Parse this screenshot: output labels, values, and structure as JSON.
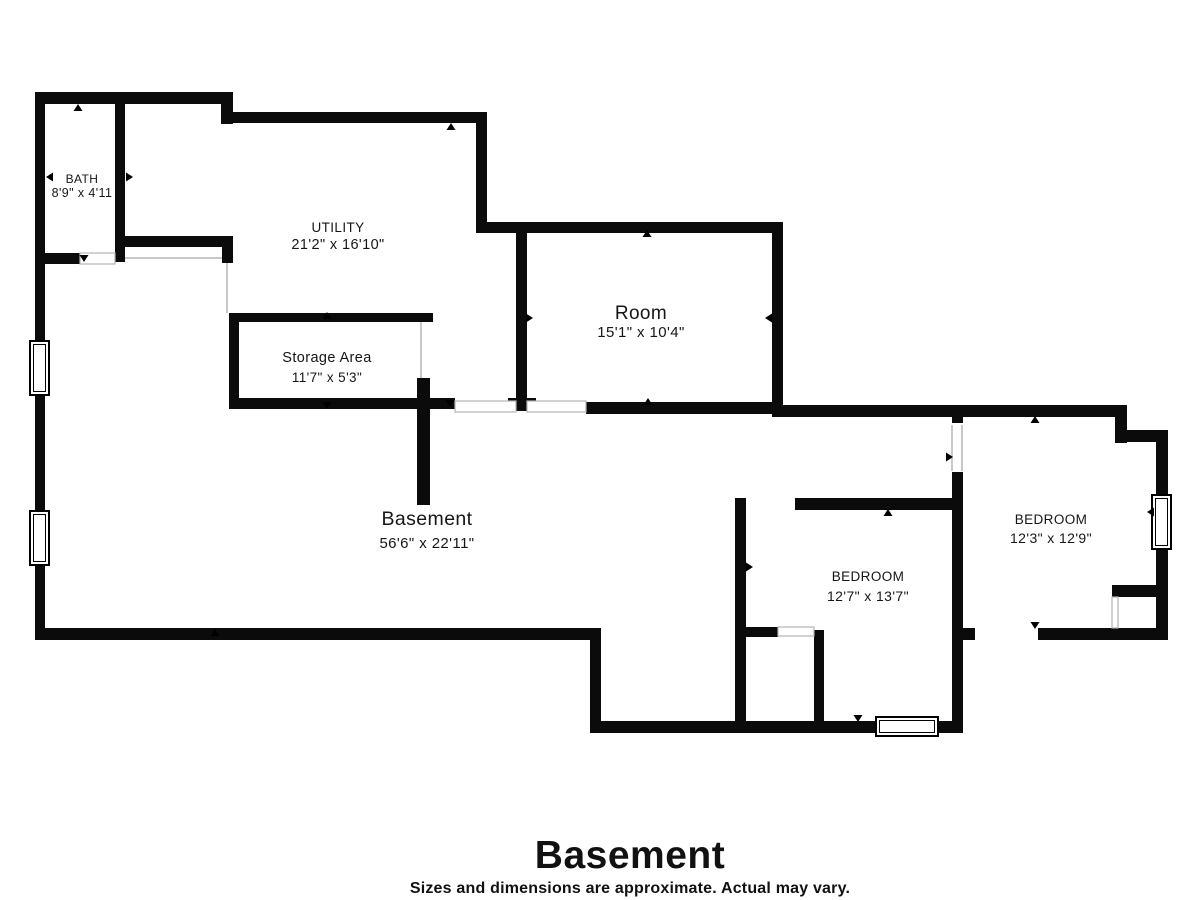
{
  "plan": {
    "wall_color": "#0b0b0b",
    "thin_color": "#b5b5b5",
    "text_color": "#161616",
    "walls": [
      [
        35,
        92,
        197,
        12
      ],
      [
        221,
        92,
        12,
        32
      ],
      [
        221,
        112,
        266,
        11
      ],
      [
        476,
        112,
        11,
        121
      ],
      [
        476,
        222,
        307,
        11
      ],
      [
        772,
        222,
        11,
        195
      ],
      [
        772,
        405,
        355,
        12
      ],
      [
        1115,
        405,
        12,
        38
      ],
      [
        1115,
        430,
        53,
        12
      ],
      [
        1156,
        430,
        12,
        210
      ],
      [
        1038,
        628,
        130,
        12
      ],
      [
        952,
        628,
        23,
        12
      ],
      [
        952,
        405,
        11,
        18
      ],
      [
        952,
        472,
        11,
        261
      ],
      [
        590,
        721,
        373,
        12
      ],
      [
        590,
        628,
        11,
        105
      ],
      [
        35,
        628,
        566,
        12
      ],
      [
        35,
        92,
        10,
        548
      ],
      [
        115,
        98,
        10,
        164
      ],
      [
        40,
        253,
        40,
        11
      ],
      [
        125,
        236,
        108,
        11
      ],
      [
        222,
        236,
        11,
        27
      ],
      [
        229,
        313,
        204,
        9
      ],
      [
        229,
        313,
        10,
        94
      ],
      [
        229,
        398,
        226,
        11
      ],
      [
        417,
        378,
        13,
        127
      ],
      [
        516,
        227,
        11,
        178
      ],
      [
        508,
        398,
        28,
        13
      ],
      [
        586,
        402,
        197,
        12
      ],
      [
        735,
        498,
        11,
        231
      ],
      [
        795,
        498,
        168,
        12
      ],
      [
        735,
        627,
        43,
        10
      ],
      [
        814,
        630,
        10,
        93
      ],
      [
        1112,
        585,
        45,
        12
      ]
    ],
    "door_openings": [
      [
        80,
        253,
        35,
        11
      ],
      [
        455,
        401,
        61,
        11
      ],
      [
        527,
        401,
        59,
        11
      ],
      [
        778,
        627,
        36,
        9
      ],
      [
        1112,
        597,
        6,
        31
      ]
    ],
    "thin_lines": [
      [
        125,
        258,
        222,
        258
      ],
      [
        227,
        263,
        227,
        313
      ],
      [
        421,
        322,
        421,
        378
      ],
      [
        952,
        425,
        952,
        471
      ],
      [
        962,
        425,
        962,
        471
      ]
    ],
    "windows": [
      [
        30,
        341,
        19,
        54
      ],
      [
        30,
        511,
        19,
        54
      ],
      [
        1152,
        495,
        19,
        54
      ],
      [
        876,
        717,
        62,
        19
      ]
    ],
    "ticks": [
      [
        78,
        104,
        "up"
      ],
      [
        451,
        123,
        "up"
      ],
      [
        133,
        177,
        "right"
      ],
      [
        46,
        177,
        "left"
      ],
      [
        84,
        262,
        "down"
      ],
      [
        327,
        312,
        "up"
      ],
      [
        327,
        409,
        "down"
      ],
      [
        450,
        407,
        "down"
      ],
      [
        533,
        318,
        "right"
      ],
      [
        648,
        398,
        "up"
      ],
      [
        647,
        230,
        "up"
      ],
      [
        765,
        318,
        "left"
      ],
      [
        888,
        509,
        "up"
      ],
      [
        753,
        567,
        "right"
      ],
      [
        1035,
        416,
        "up"
      ],
      [
        953,
        457,
        "right"
      ],
      [
        1147,
        512,
        "left"
      ],
      [
        1035,
        629,
        "down"
      ],
      [
        858,
        722,
        "down"
      ],
      [
        215,
        629,
        "up"
      ]
    ],
    "rooms": [
      {
        "id": "bath",
        "name": "BATH",
        "dims": "8'9\" x 4'11",
        "x": 82,
        "ny": 183,
        "dy": 197,
        "nfs": 12,
        "dfs": 12.5
      },
      {
        "id": "utility",
        "name": "UTILITY",
        "dims": "21'2\" x 16'10\"",
        "x": 338,
        "ny": 232,
        "dy": 249,
        "nfs": 13.5,
        "dfs": 14.5
      },
      {
        "id": "storage-area",
        "name": "Storage Area",
        "dims": "11'7\" x 5'3\"",
        "x": 327,
        "ny": 362,
        "dy": 382,
        "nfs": 14.5,
        "dfs": 13.5
      },
      {
        "id": "room",
        "name": "Room",
        "dims": "15'1\" x 10'4\"",
        "x": 641,
        "ny": 319,
        "dy": 337,
        "nfs": 19,
        "dfs": 15
      },
      {
        "id": "basement",
        "name": "Basement",
        "dims": "56'6\" x 22'11\"",
        "x": 427,
        "ny": 525,
        "dy": 548,
        "nfs": 19.5,
        "dfs": 15
      },
      {
        "id": "bedroom-1",
        "name": "BEDROOM",
        "dims": "12'7\" x 13'7\"",
        "x": 868,
        "ny": 581,
        "dy": 601,
        "nfs": 13.5,
        "dfs": 14
      },
      {
        "id": "bedroom-2",
        "name": "BEDROOM",
        "dims": "12'3\" x 12'9\"",
        "x": 1051,
        "ny": 524,
        "dy": 543,
        "nfs": 13.5,
        "dfs": 14
      }
    ]
  },
  "footer": {
    "title": "Basement",
    "subtitle": "Sizes and dimensions are approximate. Actual may vary."
  }
}
